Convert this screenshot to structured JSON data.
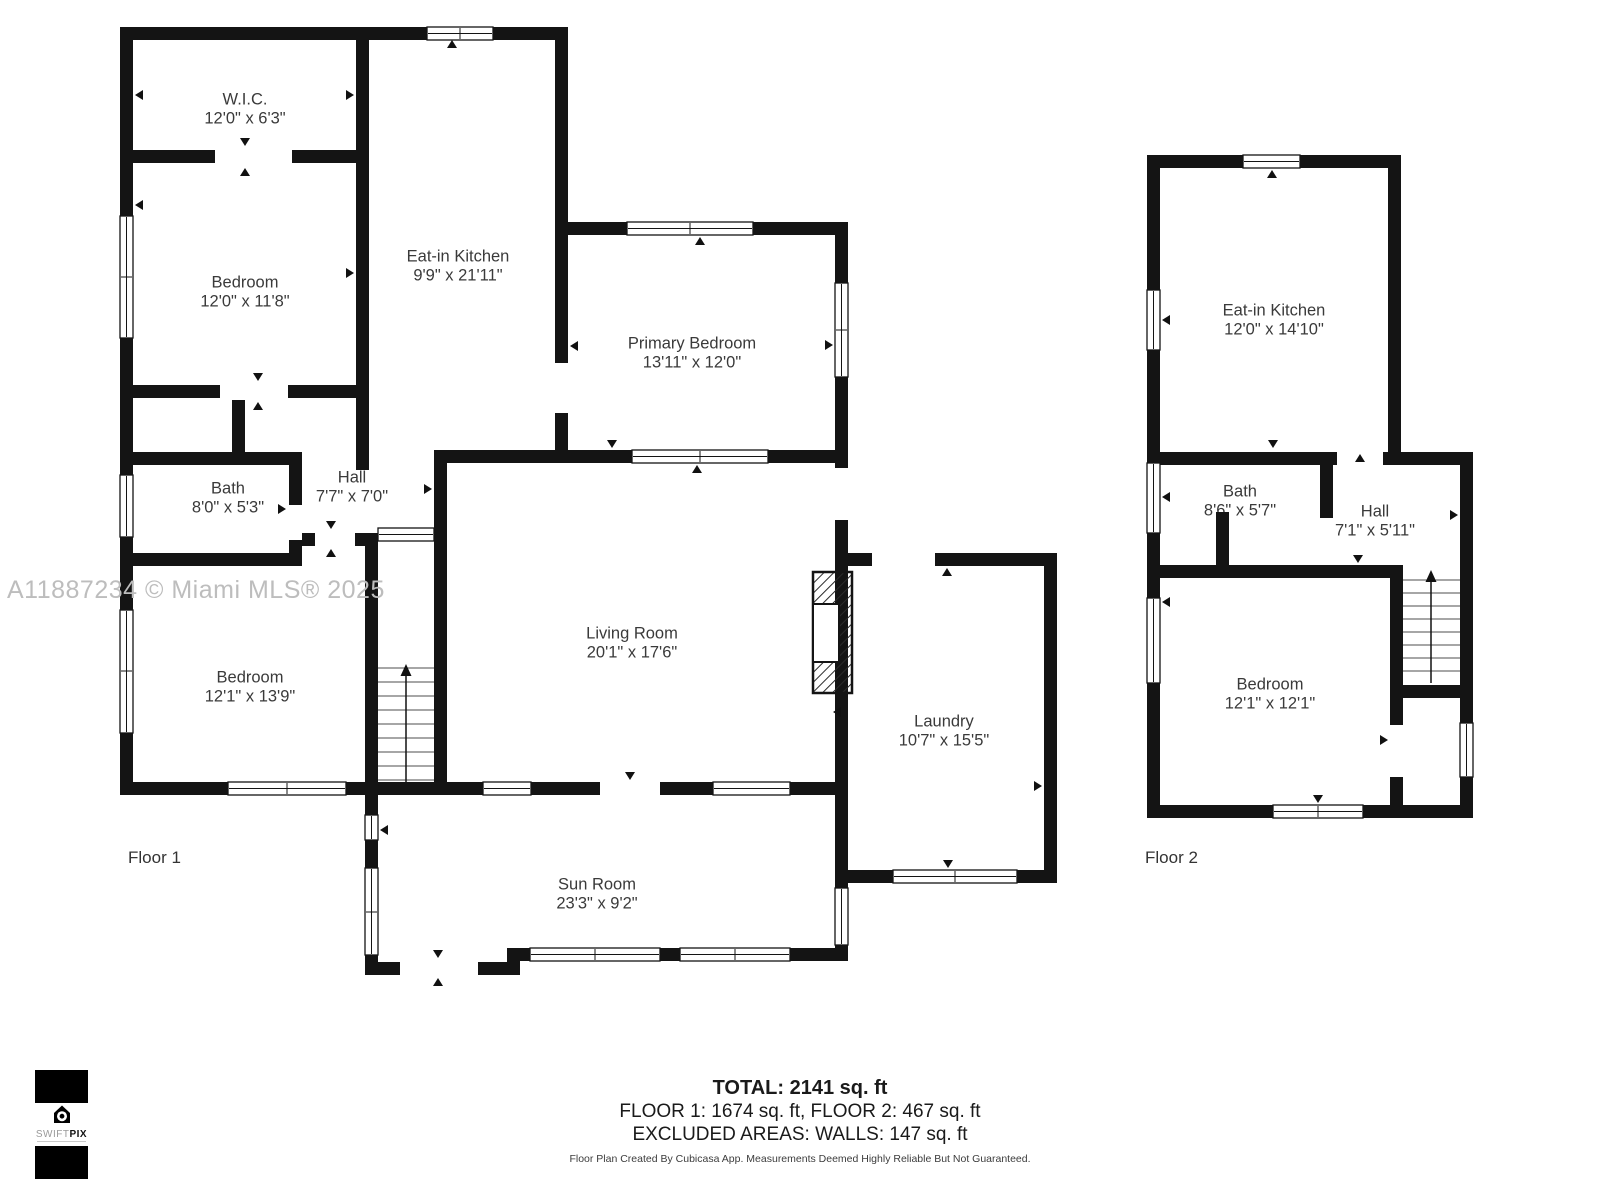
{
  "colors": {
    "wall": "#141414",
    "watermark": "#bdbdbd",
    "label_text": "#3a3a3a",
    "disclaimer_text": "#3c3c3c"
  },
  "watermark": "A11887234 © Miami MLS® 2025",
  "floor_labels": {
    "floor1": "Floor 1",
    "floor2": "Floor 2"
  },
  "rooms": [
    {
      "id": "wic",
      "floor": 1,
      "name": "W.I.C.",
      "dims": "12'0\" x 6'3\""
    },
    {
      "id": "bedroom-upper-left",
      "floor": 1,
      "name": "Bedroom",
      "dims": "12'0\" x 11'8\""
    },
    {
      "id": "eat-in-kitchen-f1",
      "floor": 1,
      "name": "Eat-in Kitchen",
      "dims": "9'9\" x 21'11\""
    },
    {
      "id": "primary-bedroom",
      "floor": 1,
      "name": "Primary Bedroom",
      "dims": "13'11\" x 12'0\""
    },
    {
      "id": "bath-f1",
      "floor": 1,
      "name": "Bath",
      "dims": "8'0\" x 5'3\""
    },
    {
      "id": "hall-f1",
      "floor": 1,
      "name": "Hall",
      "dims": "7'7\" x 7'0\""
    },
    {
      "id": "bedroom-lower-left",
      "floor": 1,
      "name": "Bedroom",
      "dims": "12'1\" x 13'9\""
    },
    {
      "id": "living-room",
      "floor": 1,
      "name": "Living Room",
      "dims": "20'1\" x 17'6\""
    },
    {
      "id": "laundry",
      "floor": 1,
      "name": "Laundry",
      "dims": "10'7\" x 15'5\""
    },
    {
      "id": "sun-room",
      "floor": 1,
      "name": "Sun Room",
      "dims": "23'3\" x 9'2\""
    },
    {
      "id": "eat-in-kitchen-f2",
      "floor": 2,
      "name": "Eat-in Kitchen",
      "dims": "12'0\" x 14'10\""
    },
    {
      "id": "bath-f2",
      "floor": 2,
      "name": "Bath",
      "dims": "8'6\" x 5'7\""
    },
    {
      "id": "hall-f2",
      "floor": 2,
      "name": "Hall",
      "dims": "7'1\" x 5'11\""
    },
    {
      "id": "bedroom-f2",
      "floor": 2,
      "name": "Bedroom",
      "dims": "12'1\" x 12'1\""
    }
  ],
  "summary": {
    "total": "TOTAL: 2141 sq. ft",
    "floors": "FLOOR 1: 1674 sq. ft, FLOOR 2: 467 sq. ft",
    "excluded": "EXCLUDED AREAS: WALLS: 147 sq. ft",
    "disclaimer": "Floor Plan Created By Cubicasa App. Measurements Deemed Highly Reliable But Not Guaranteed."
  },
  "logo": {
    "brand_light": "SWIFT",
    "brand_bold": "PIX"
  }
}
